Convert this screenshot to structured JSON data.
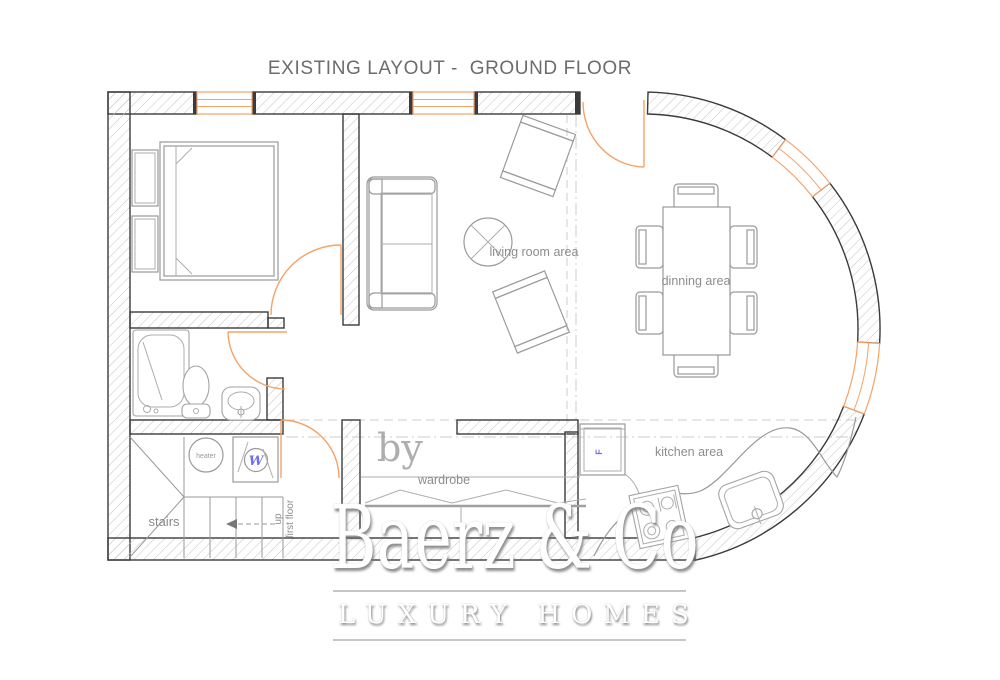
{
  "title": "EXISTING LAYOUT -  GROUND FLOOR",
  "rooms": {
    "living_room": "living room area",
    "dining": "dinning area",
    "kitchen": "kitchen area",
    "wardrobe": "wardrobe",
    "stairs": "stairs",
    "stairs_direction_line1": "up",
    "stairs_direction_line2": "first floor"
  },
  "equipment": {
    "heater": "heater",
    "washer": "W",
    "fridge": "F"
  },
  "watermark": {
    "prefix": "by",
    "brand": "Baerz & Co",
    "tagline": "LUXURY HOMES"
  },
  "colors": {
    "walls": "#3b3b3b",
    "hatch": "#c4c4c4",
    "openings": "#F4A368",
    "furniture": "#9a9a9a",
    "labels": "#8d8d8d",
    "appliance_text": "#7070e8",
    "title": "#6c6c6c",
    "watermark": "#ffffff"
  }
}
